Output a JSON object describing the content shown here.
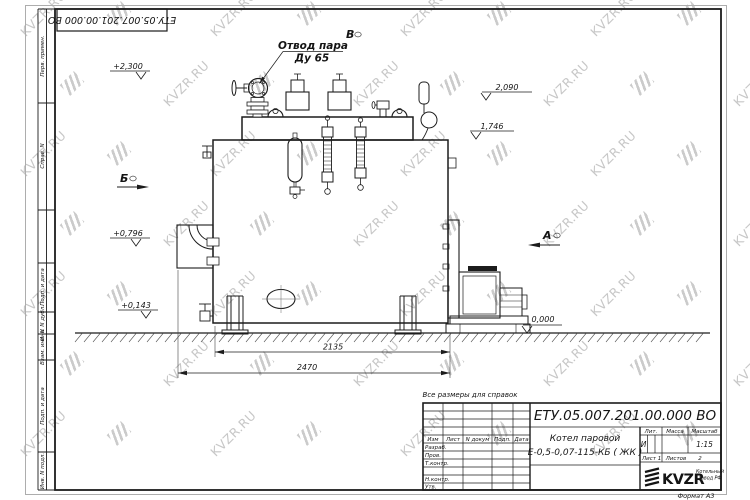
{
  "watermark": {
    "text": "KVZR.RU"
  },
  "sheet": {
    "format_label": "Формат А3",
    "corner_designation": "ЕТУ.05.007.201.00.000  ВО",
    "margin_boxes": {
      "b1": "Перв. примен.",
      "b2": "Справ. N",
      "b3": "Подп. и дата",
      "b4": "Инв. N дубл.",
      "b5": "Взам. инв. N",
      "b6": "Подп. и дата",
      "b7": "Инв. N подл."
    }
  },
  "drawing": {
    "note": "Все размеры для справок",
    "callout": {
      "line1": "Отвод пара",
      "line2": "Ду 65"
    },
    "views": {
      "top": "В",
      "left": "Б",
      "right": "А"
    },
    "elevations": {
      "e1": "+2,300",
      "e2": "2,090",
      "e3": "1,746",
      "e4": "+0,796",
      "e5": "+0,143",
      "e6": "0,000"
    },
    "dims": {
      "length_body": "2135",
      "length_overall": "2470"
    }
  },
  "title_block": {
    "designation": "ЕТУ.05.007.201.00.000  ВО",
    "product_line1": "Котел паровой",
    "product_line2": "Е-0,5-0,07-115-КБ ( ЖК )",
    "cols": {
      "izm": "Изм",
      "list": "Лист",
      "ndoc": "N докум",
      "podp": "Подп.",
      "data": "Дата"
    },
    "rows": {
      "r1": "Разраб.",
      "r2": "Пров.",
      "r3": "Т.контр.",
      "r4": "Н.контр.",
      "r5": "Утв."
    },
    "lit_label": "Лит.",
    "lit_value": "И",
    "mass_label": "Масса",
    "scale_label": "Масштаб",
    "scale_value": "1:15",
    "sheet_label": "Лист",
    "sheet_value": "1",
    "sheets_label": "Листов",
    "sheets_value": "2",
    "logo_text": "KVZR",
    "company_line1": "Котельный",
    "company_line2": "завод РФ"
  }
}
